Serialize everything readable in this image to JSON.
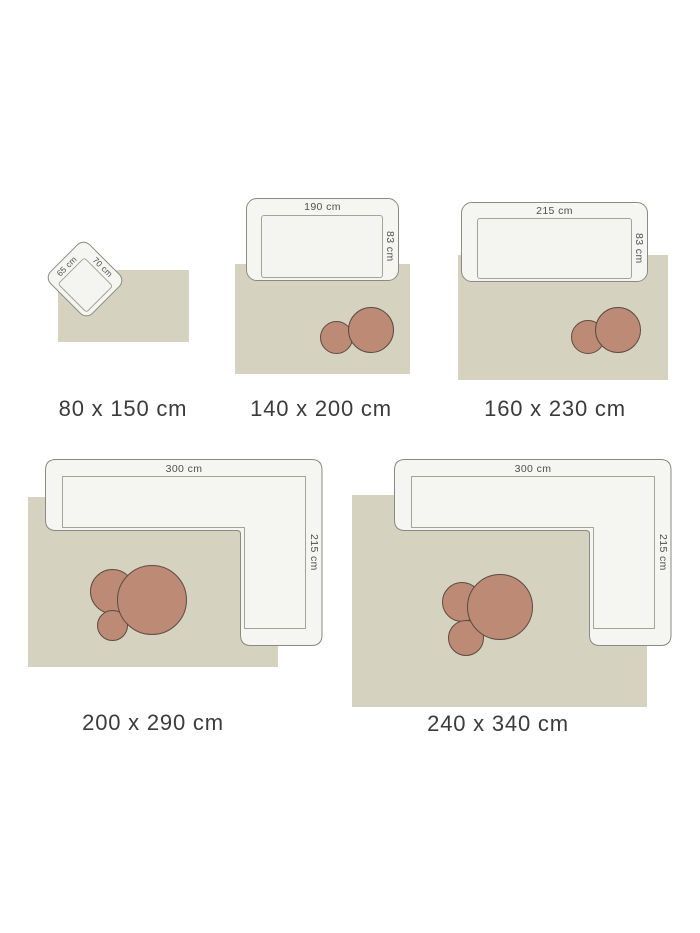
{
  "page": {
    "description_labels": []
  },
  "colors": {
    "background": "#ffffff",
    "rug": "#d5d2bf",
    "sofa_fill": "#f5f5f2",
    "sofa_border": "#8a8a83",
    "sofa_seat_border": "#a3a39b",
    "coffee_table_fill": "#bd8a76",
    "coffee_table_border": "#5a4c41",
    "caption_text": "#3b3b3b",
    "dimension_text": "#4f4f4f"
  },
  "diagrams": [
    {
      "caption": "80 x 150 cm",
      "furniture": {
        "type": "side-table",
        "width_label": "65 cm",
        "depth_label": "70 cm"
      },
      "coffee_tables": 0
    },
    {
      "caption": "140 x 200 cm",
      "furniture": {
        "type": "sofa",
        "width_label": "190 cm",
        "depth_label": "83 cm"
      },
      "coffee_tables": 2
    },
    {
      "caption": "160 x 230 cm",
      "furniture": {
        "type": "sofa",
        "width_label": "215 cm",
        "depth_label": "83 cm"
      },
      "coffee_tables": 2
    },
    {
      "caption": "200 x 290 cm",
      "furniture": {
        "type": "corner-sofa",
        "width_label": "300 cm",
        "depth_label": "215 cm"
      },
      "coffee_tables": 3
    },
    {
      "caption": "240 x 340 cm",
      "furniture": {
        "type": "corner-sofa",
        "width_label": "300 cm",
        "depth_label": "215 cm"
      },
      "coffee_tables": 3
    }
  ]
}
